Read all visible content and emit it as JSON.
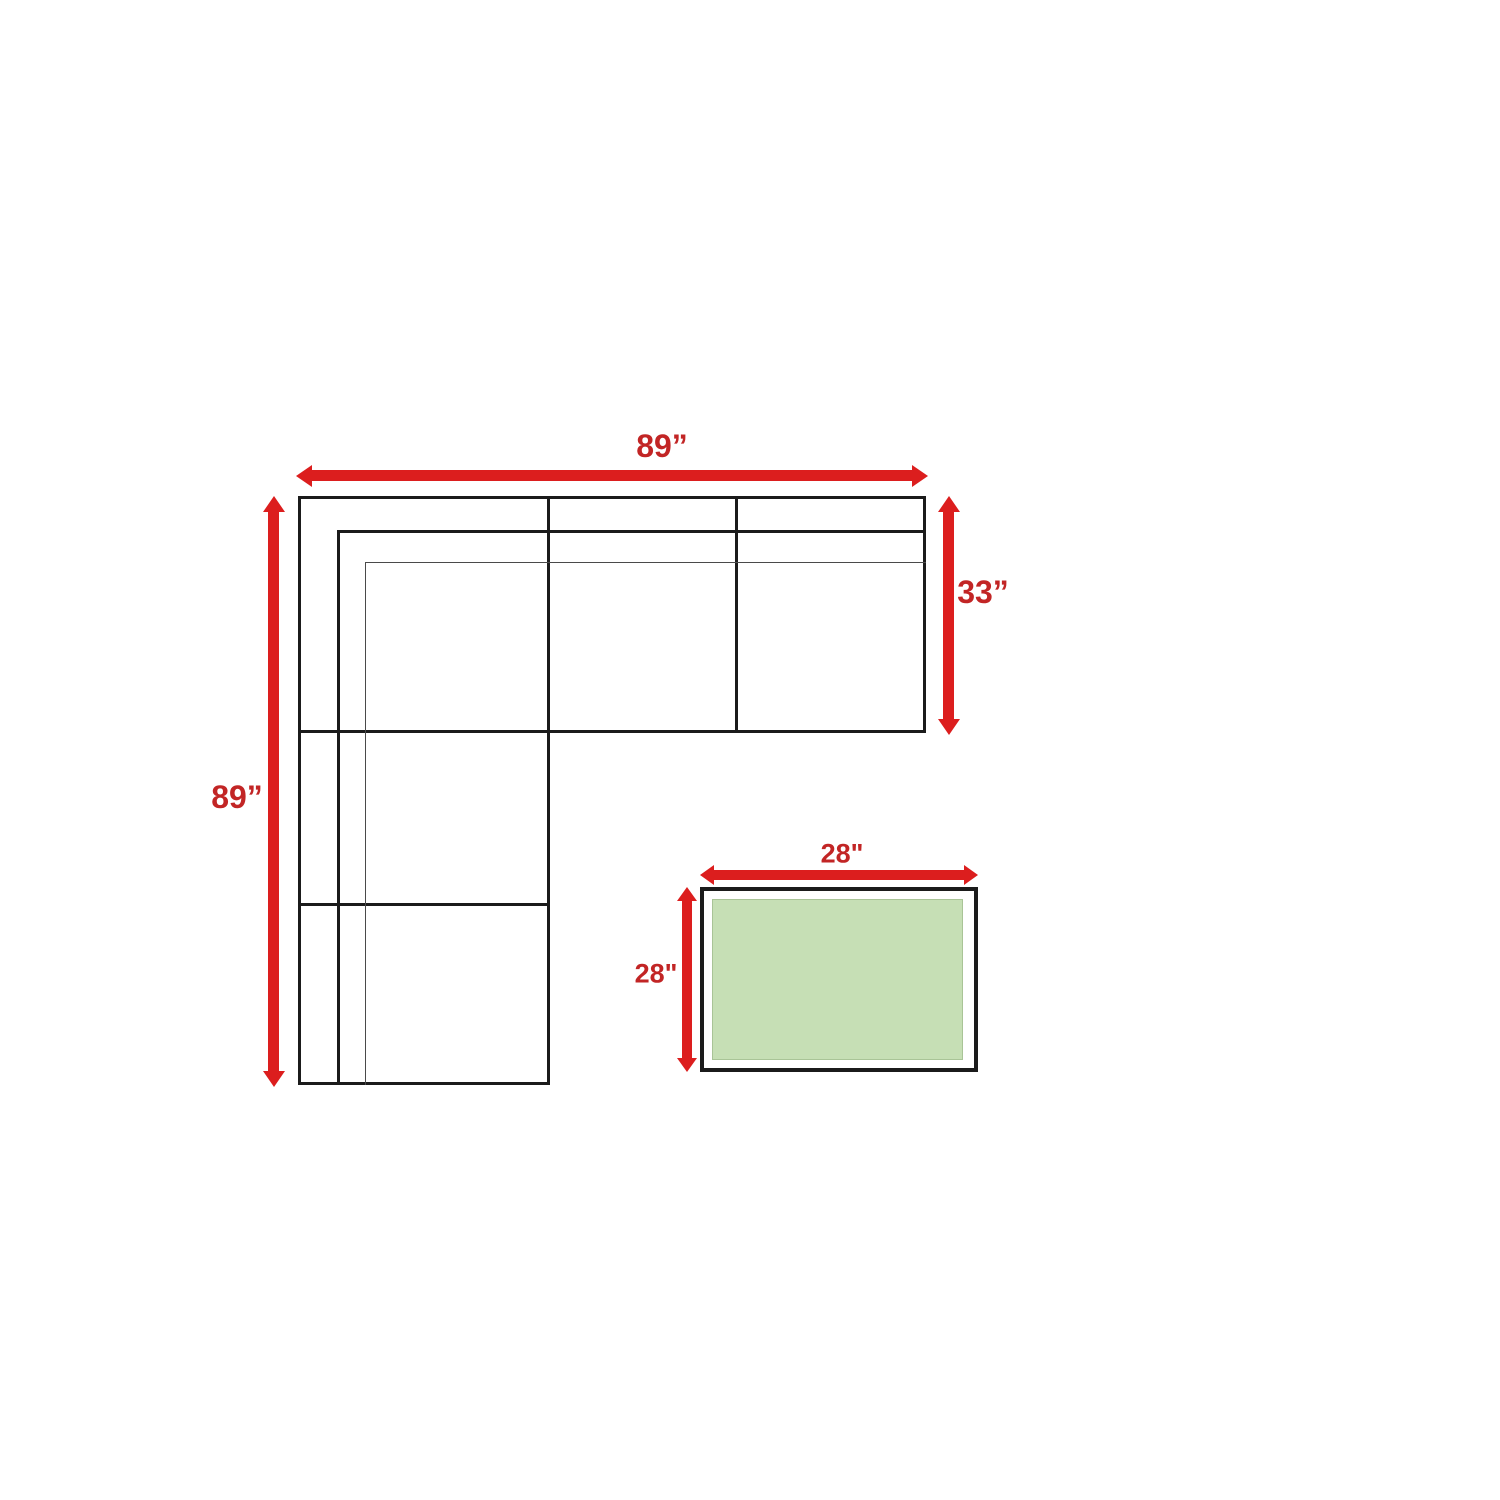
{
  "diagram": {
    "sofa": {
      "width_label": "89”",
      "depth_label": "89”",
      "section_depth_label": "33”"
    },
    "table": {
      "width_label": "28\"",
      "depth_label": "28\""
    },
    "colors": {
      "arrow_red": "#dc1e1e",
      "label_red": "#c22525",
      "outline_black": "#1b1b1b",
      "thin_gray": "#4a4a4a",
      "table_green": "#c6dfb5",
      "table_green_border": "#a9c497",
      "bg": "#ffffff"
    }
  }
}
